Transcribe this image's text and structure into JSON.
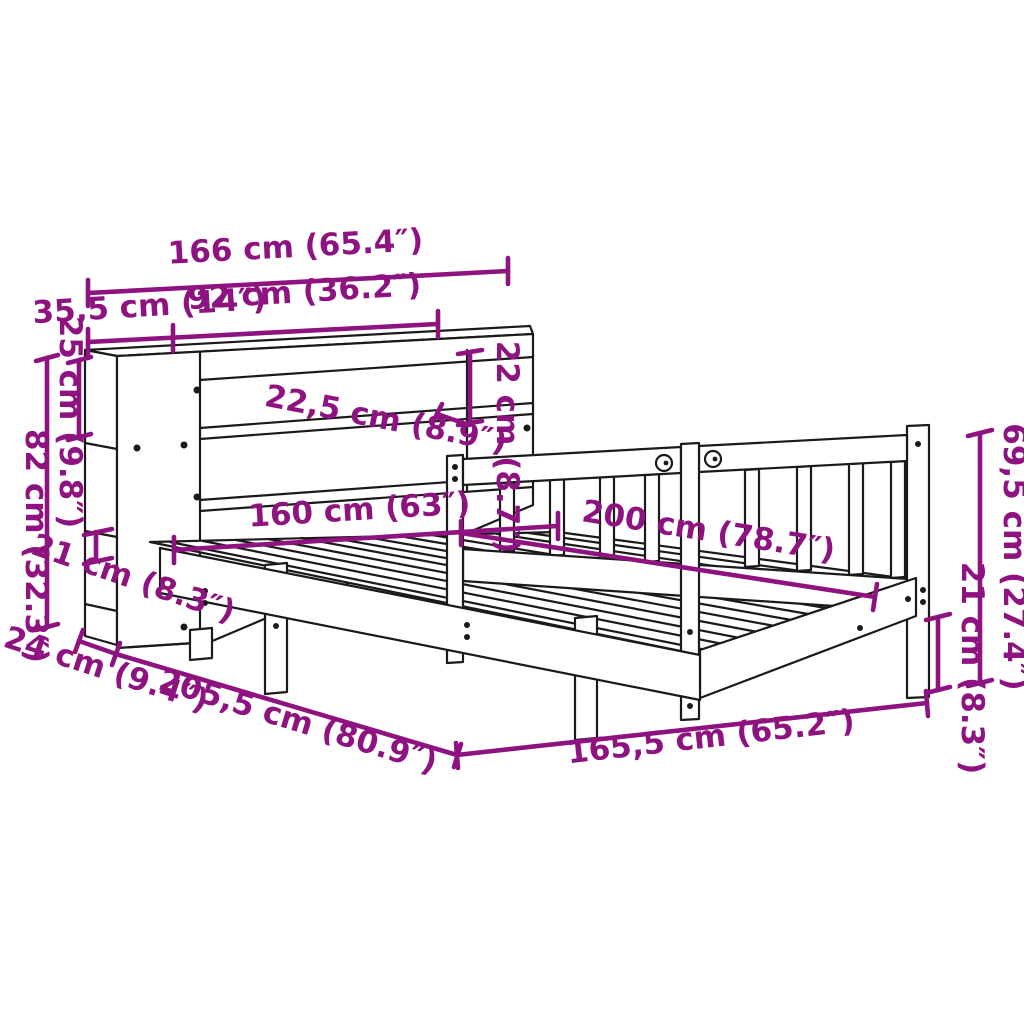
{
  "figure": {
    "type": "product-dimension-diagram",
    "subject": "bed frame with bookcase headboard and slatted rail"
  },
  "colors": {
    "dimension_annotation": "#8E1280",
    "line_art": "#1a1a1a",
    "background": "#ffffff"
  },
  "dimensions": {
    "headboard_total_width": {
      "label": "166 cm (65.4″)"
    },
    "side_section_width": {
      "label": "35,5 cm (14″)"
    },
    "shelf_opening_width": {
      "label": "92 cm (36.2″)"
    },
    "top_compartment_height": {
      "label": "22 cm (8.7″)"
    },
    "shelf_spacing": {
      "label": "22,5 cm (8.9″)"
    },
    "side_compartment_height": {
      "label": "25 cm (9.8″)"
    },
    "headboard_height": {
      "label": "82 cm (32.3″)"
    },
    "clearance_left": {
      "label": "21 cm (8.3″)"
    },
    "headboard_depth": {
      "label": "24 cm (9.4″)"
    },
    "total_length": {
      "label": "205,5 cm (80.9″)"
    },
    "frame_outer_width": {
      "label": "165,5 cm (65.2″)"
    },
    "mattress_width": {
      "label": "160 cm (63″)"
    },
    "mattress_length": {
      "label": "200 cm (78.7″)"
    },
    "rail_height": {
      "label": "69,5 cm (27.4″)"
    },
    "clearance_right": {
      "label": "21 cm (8.3″)"
    }
  }
}
